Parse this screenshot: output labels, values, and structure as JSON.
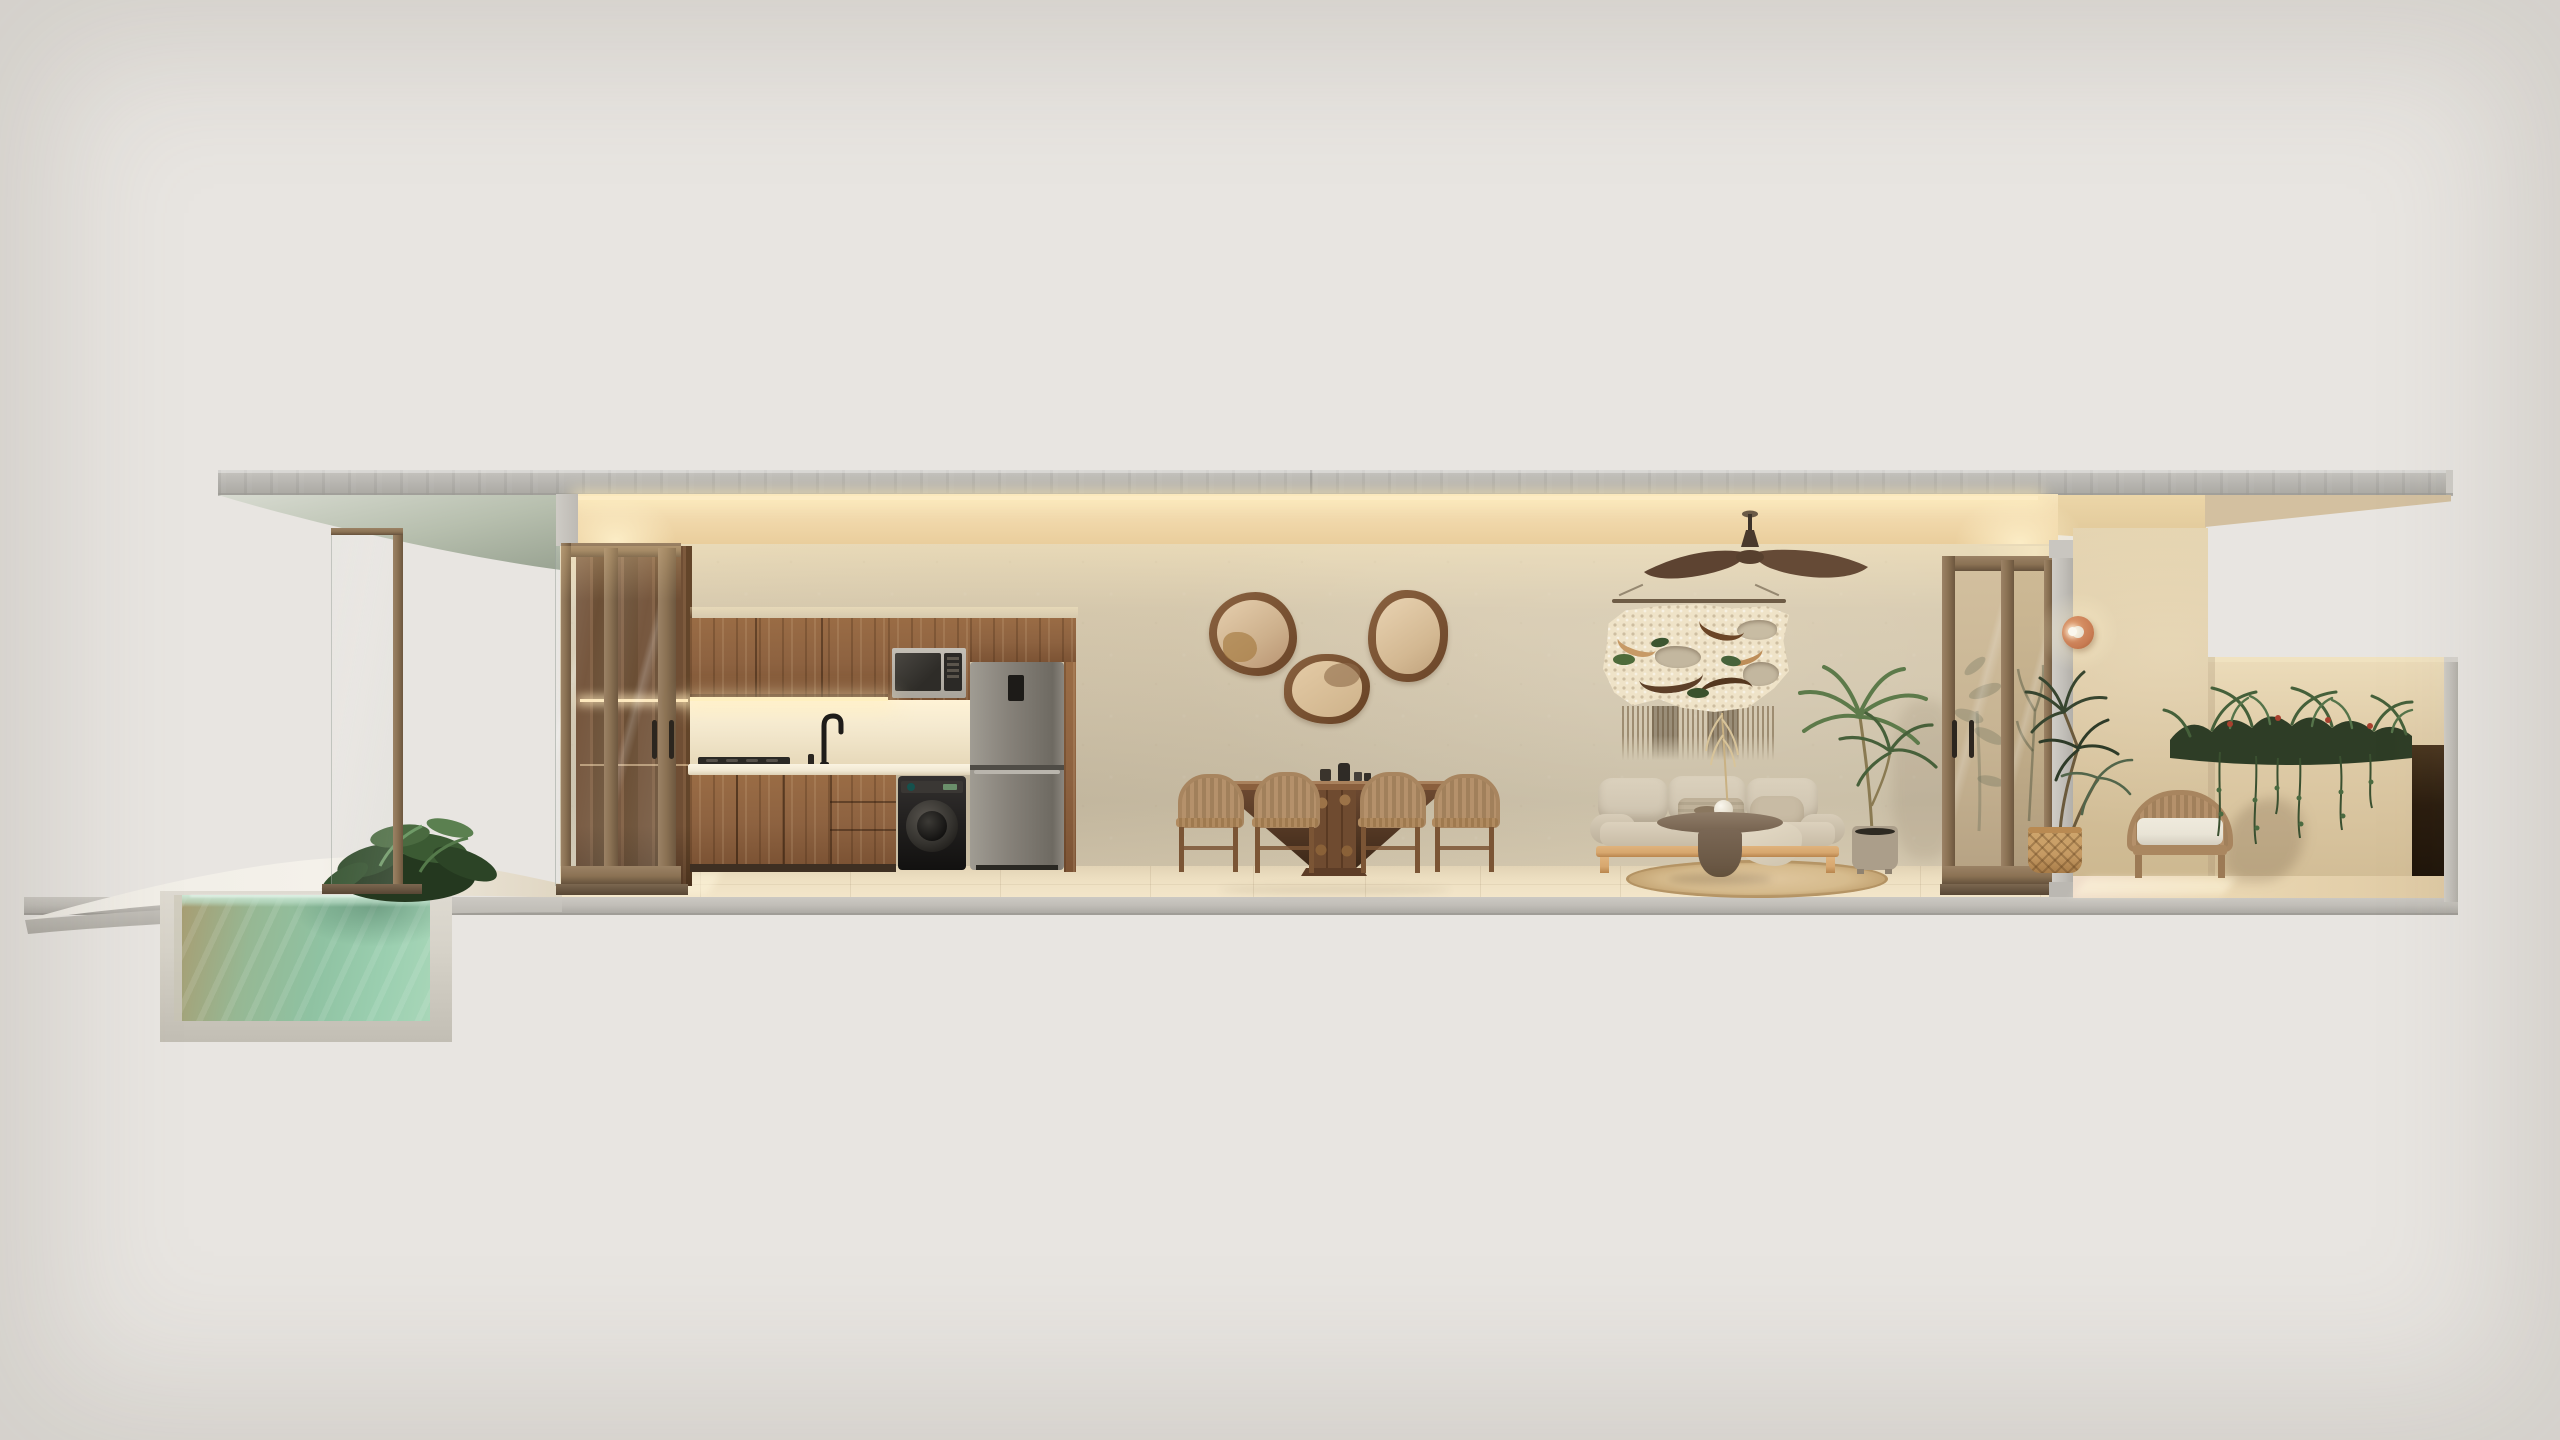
{
  "caption": "Photorealistic cross-section rendering of a single-storey villa suite: cantilevered concrete roof slab, sunken plunge pool and curved deck at left, then behind sliding bronze-framed glass doors a walnut kitchen with fridge, microwave and washer, a dining set with three organic wood mirrors, a living area with ceiling fan, macrame wall hanging, beige sofa, round coffee table and potted palm, and at right an open terrace with terracotta sconce, rattan armchair, dracaena in a basket and a planter wall of trailing greenery.",
  "scene": {
    "areas": [
      {
        "name": "pool-deck",
        "items": [
          "curved-concrete-deck",
          "plunge-pool-section",
          "pool-water",
          "deck-plant"
        ]
      },
      {
        "name": "kitchen",
        "items": [
          "pantry-wardrobe",
          "sliding-door-left",
          "upper-cabinets",
          "microwave",
          "fridge",
          "washer",
          "cooktop",
          "faucet",
          "backsplash-led",
          "base-cabinets"
        ]
      },
      {
        "name": "dining",
        "items": [
          "organic-mirror-1",
          "organic-mirror-2",
          "organic-mirror-3",
          "pedestal-dining-table",
          "dining-chairs-x4",
          "tableware"
        ]
      },
      {
        "name": "living",
        "items": [
          "ceiling-fan",
          "macrame-wall-hanging",
          "three-seat-sofa",
          "round-coffee-table",
          "jute-rug",
          "potted-palm"
        ]
      },
      {
        "name": "terrace",
        "items": [
          "sliding-door-right",
          "terracotta-sconce",
          "dracaena-basket-plant",
          "rattan-armchair",
          "parapet-planter-greenery",
          "shadow-recess"
        ]
      }
    ]
  },
  "colors": {
    "bg": "#e8e5e1",
    "roof": "#b9b7b2",
    "ceiling": "#f0d7a9",
    "cove_glow": "#ffeec6",
    "wall": "#d2c6ad",
    "wall_top": "#e9dab8",
    "floor": "#eee0c2",
    "slab": "#c1beb8",
    "wood_cabinet": "#8d6240",
    "walnut_dark": "#5f432d",
    "bronze": "#8b7254",
    "fridge_steel": "#87827a",
    "appliance_black": "#23211e",
    "counter": "#f1e8d3",
    "water": "#8fc2a2",
    "water_olive": "#a89d72",
    "pool_concrete": "#d6d2c8",
    "plant_green": "#3f5433",
    "plant_dark": "#2c3a24",
    "sofa_beige": "#cdc2ae",
    "oak_frame": "#d7a76e",
    "table_taupe": "#7e6a57",
    "rug_jute": "#d6bb8d",
    "rattan": "#b5916b",
    "cushion_white": "#e9e4d6",
    "terracotta": "#c87c53",
    "terrace_plaster": "#dbc7a3",
    "mirror_glass": "#dfc8a8",
    "macrame_cream": "#efe3c8"
  }
}
